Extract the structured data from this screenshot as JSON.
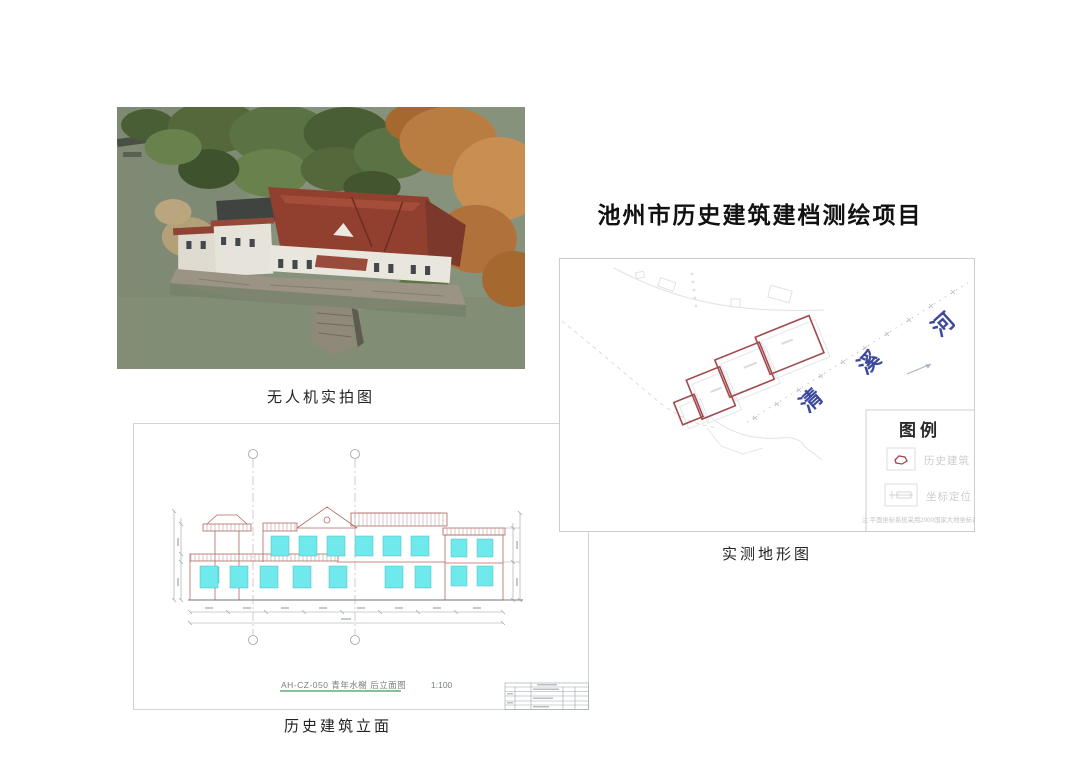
{
  "page": {
    "title": "池州市历史建筑建档测绘项目"
  },
  "photo": {
    "caption": "无人机实拍图"
  },
  "map": {
    "caption": "实测地形图",
    "river_name_chars": [
      "清",
      "溪",
      "河"
    ],
    "legend": {
      "title": "图例",
      "items": [
        {
          "symbol": "historic-building-outline",
          "label": "历史建筑"
        },
        {
          "symbol": "coordinate-stamp",
          "label": "坐标定位"
        }
      ],
      "note": "注:平面坐标系统采用2000国家大地坐标系"
    }
  },
  "elevation": {
    "caption": "历史建筑立面",
    "drawing_title": "AH-CZ-050 青年水榭 后立面图",
    "scale": "1:100"
  },
  "colors": {
    "building_outline_red": "#a3494d",
    "river_blue": "#3c4a9c",
    "window_cyan": "#6fe9ec",
    "cad_line_red": "#b06a63",
    "underline_green": "#3aa055"
  }
}
